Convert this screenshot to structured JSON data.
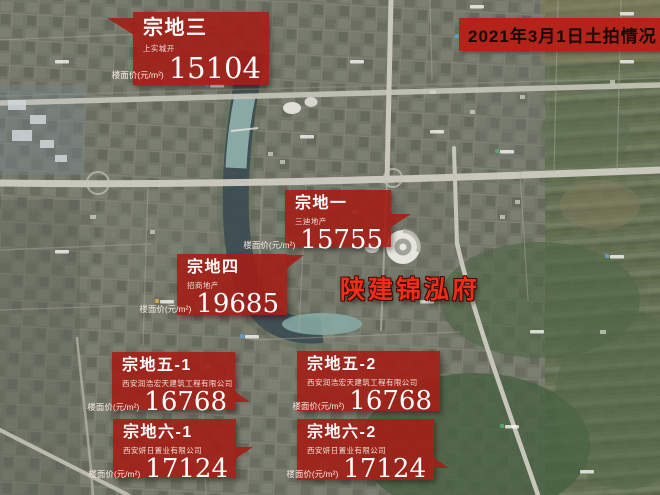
{
  "header": {
    "event_title": "2021年3月1日土拍情况"
  },
  "watermark": {
    "text": "陕建锦泓府"
  },
  "price_label": "楼面价(元/m²)",
  "parcels": [
    {
      "name": "宗地三",
      "company": "上实城开",
      "price": "15104"
    },
    {
      "name": "宗地一",
      "company": "三迪地产",
      "price": "15755"
    },
    {
      "name": "宗地四",
      "company": "招商地产",
      "price": "19685"
    },
    {
      "name": "宗地五-1",
      "company": "西安润浩宏天建筑工程有限公司",
      "price": "16768"
    },
    {
      "name": "宗地五-2",
      "company": "西安润浩宏天建筑工程有限公司",
      "price": "16768"
    },
    {
      "name": "宗地六-1",
      "company": "西安妍日置业有限公司",
      "price": "17124"
    },
    {
      "name": "宗地六-2",
      "company": "西安妍日置业有限公司",
      "price": "17124"
    }
  ],
  "colors": {
    "annotation_red": "#a31e16",
    "title_box_red": "#b3231a",
    "watermark_red": "#ee2d1b"
  }
}
